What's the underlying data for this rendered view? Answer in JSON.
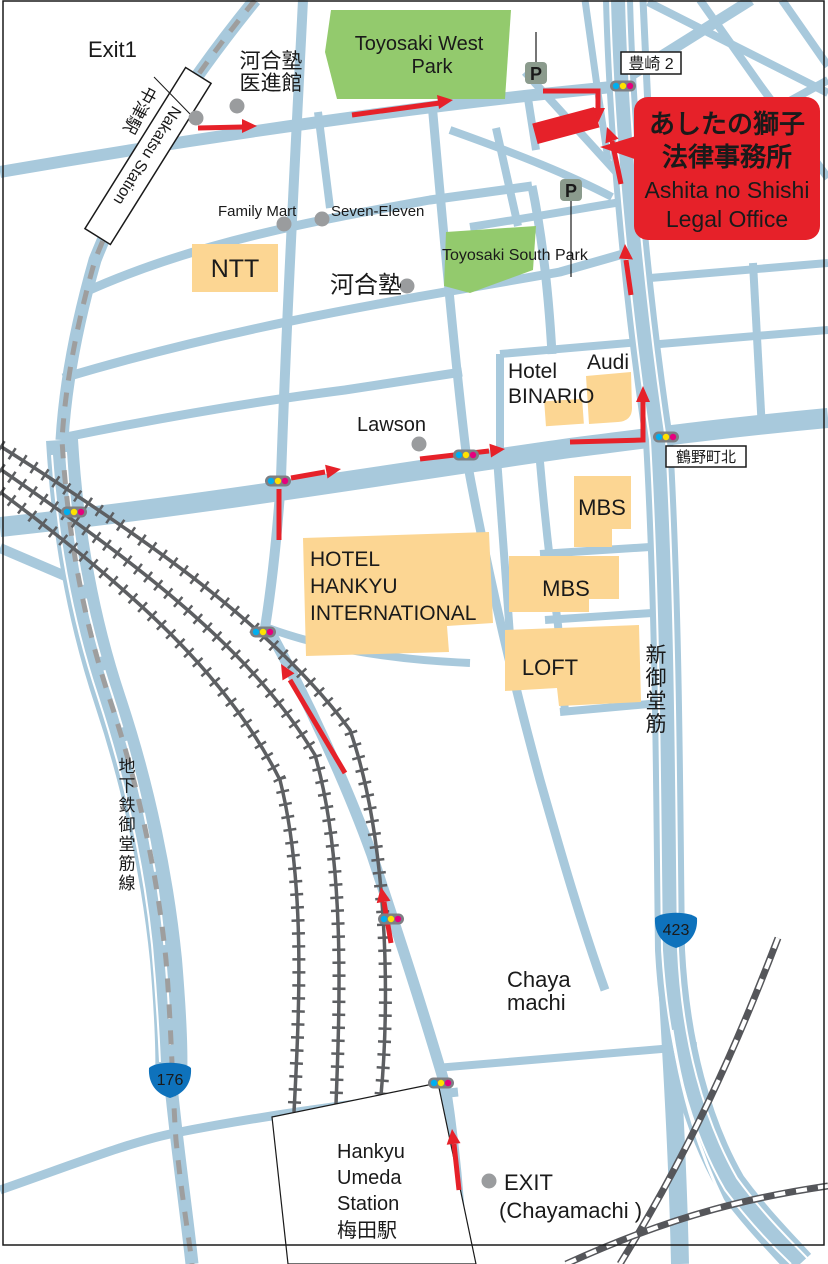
{
  "title": "Access map — Ashita no Shishi Legal Office",
  "colors": {
    "road": "#a8c9dc",
    "park": "#93ca6d",
    "building": "#fcd693",
    "route_red": "#e62129",
    "railway_gray": "#5d5f62",
    "subway_dash_gray": "#9e9e9e",
    "signal_body": "#7d7f83",
    "signal_cyan": "#00aeef",
    "signal_yellow": "#ffe100",
    "signal_magenta": "#e5007e",
    "poi_dot": "#9a9c9e",
    "parking_green": "#8b9b8d",
    "shield_blue": "#0e72bc"
  },
  "labels": {
    "exit1": "Exit1",
    "nakatsu_en": "Nakatsu Station",
    "nakatsu_jp": "中津駅",
    "kawaijuku_med_l1": "河合塾",
    "kawaijuku_med_l2": "医進館",
    "toyosaki_west_l1": "Toyosaki West",
    "toyosaki_west_l2": "Park",
    "parking": "P",
    "toyosaki2": "豊崎 2",
    "family_mart": "Family Mart",
    "seven_eleven": "Seven-Eleven",
    "ntt": "NTT",
    "kawaijuku": "河合塾",
    "toyosaki_south": "Toyosaki South Park",
    "hotel": "Hotel",
    "binario": "BINARIO",
    "audi": "Audi",
    "lawson": "Lawson",
    "tsurunocho_kita": "鶴野町北",
    "mbs": "MBS",
    "loft": "LOFT",
    "hankyu_intl_l1": "HOTEL",
    "hankyu_intl_l2": "HANKYU",
    "hankyu_intl_l3": "INTERNATIONAL",
    "shin_midosuji": "新御堂筋",
    "subway_line": "地下鉄御堂筋線",
    "route_423": "423",
    "route_176": "176",
    "chaya_l1": "Chaya",
    "chaya_l2": "machi",
    "hankyu_umeda_l1": "Hankyu",
    "hankyu_umeda_l2": "Umeda",
    "hankyu_umeda_l3": "Station",
    "hankyu_umeda_l4": "梅田駅",
    "exit_chayamachi_l1": "EXIT",
    "exit_chayamachi_l2": "(Chayamachi )"
  },
  "callout": {
    "jp1": "あしたの獅子",
    "jp2": "法律事務所",
    "en1": "Ashita no Shishi",
    "en2": "Legal Office"
  }
}
